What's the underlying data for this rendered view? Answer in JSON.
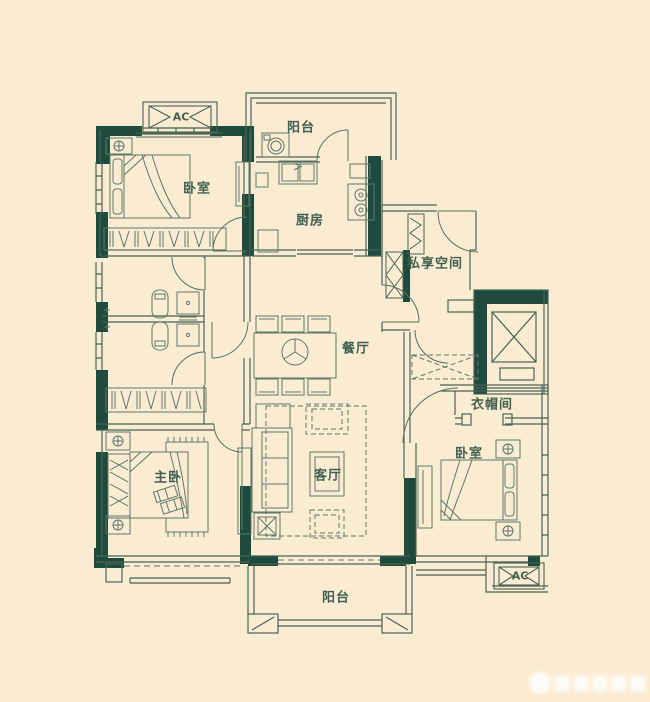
{
  "meta": {
    "type": "apartment-floor-plan"
  },
  "colors": {
    "background": "#f9ecd2",
    "wall_dark": "#1e4b3d",
    "line": "#4a6353",
    "furniture_line": "#5e7767",
    "label_text": "#42604f",
    "watermark": "#ffffff"
  },
  "rooms": [
    {
      "id": "bedroom-top-left",
      "label": "卧室"
    },
    {
      "id": "balcony-top",
      "label": "阳台"
    },
    {
      "id": "kitchen",
      "label": "厨房"
    },
    {
      "id": "private-space",
      "label": "私享空间"
    },
    {
      "id": "dining-room",
      "label": "餐厅"
    },
    {
      "id": "cloakroom",
      "label": "衣帽间"
    },
    {
      "id": "bedroom-right",
      "label": "卧室"
    },
    {
      "id": "master-bedroom",
      "label": "主卧"
    },
    {
      "id": "living-room",
      "label": "客厅"
    },
    {
      "id": "balcony-bottom",
      "label": "阳台"
    }
  ],
  "ac_units": [
    {
      "id": "ac-top-left",
      "label": "AC"
    },
    {
      "id": "ac-bottom-right",
      "label": "AC"
    }
  ],
  "watermark": {
    "description": "illegible blurred white logo watermark"
  }
}
